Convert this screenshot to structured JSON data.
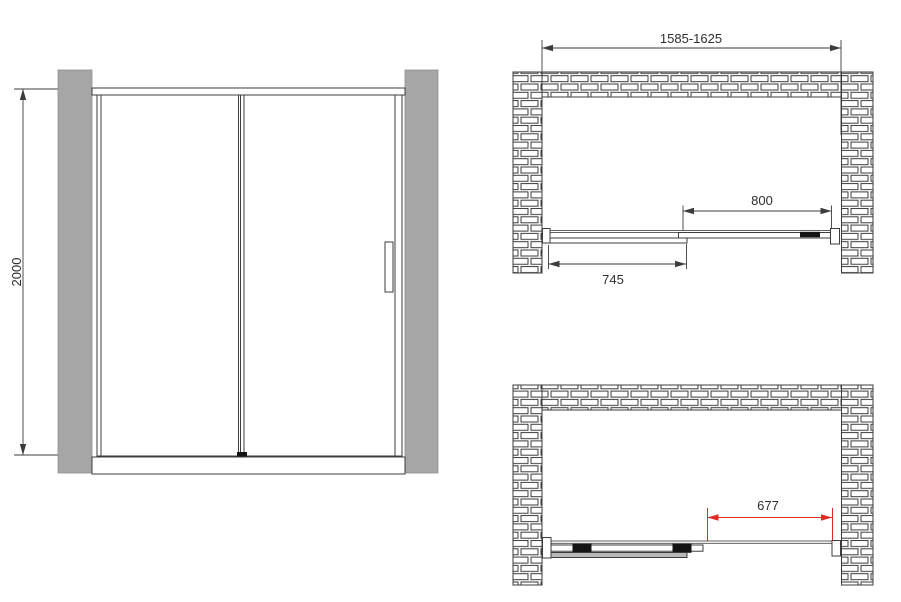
{
  "colors": {
    "line": "#3c3c3c",
    "wall_fill": "#a6a6a6",
    "panel_gray": "#b9b9b9",
    "dim_red": "#e02b20",
    "text": "#2e2e2e"
  },
  "front_view": {
    "height_dim_label": "2000"
  },
  "plan_view_closed": {
    "overall_width_dim_label": "1585-1625",
    "sliding_panel_dim_label": "800",
    "fixed_panel_dim_label": "745"
  },
  "plan_view_open": {
    "opening_width_dim_label": "677"
  }
}
